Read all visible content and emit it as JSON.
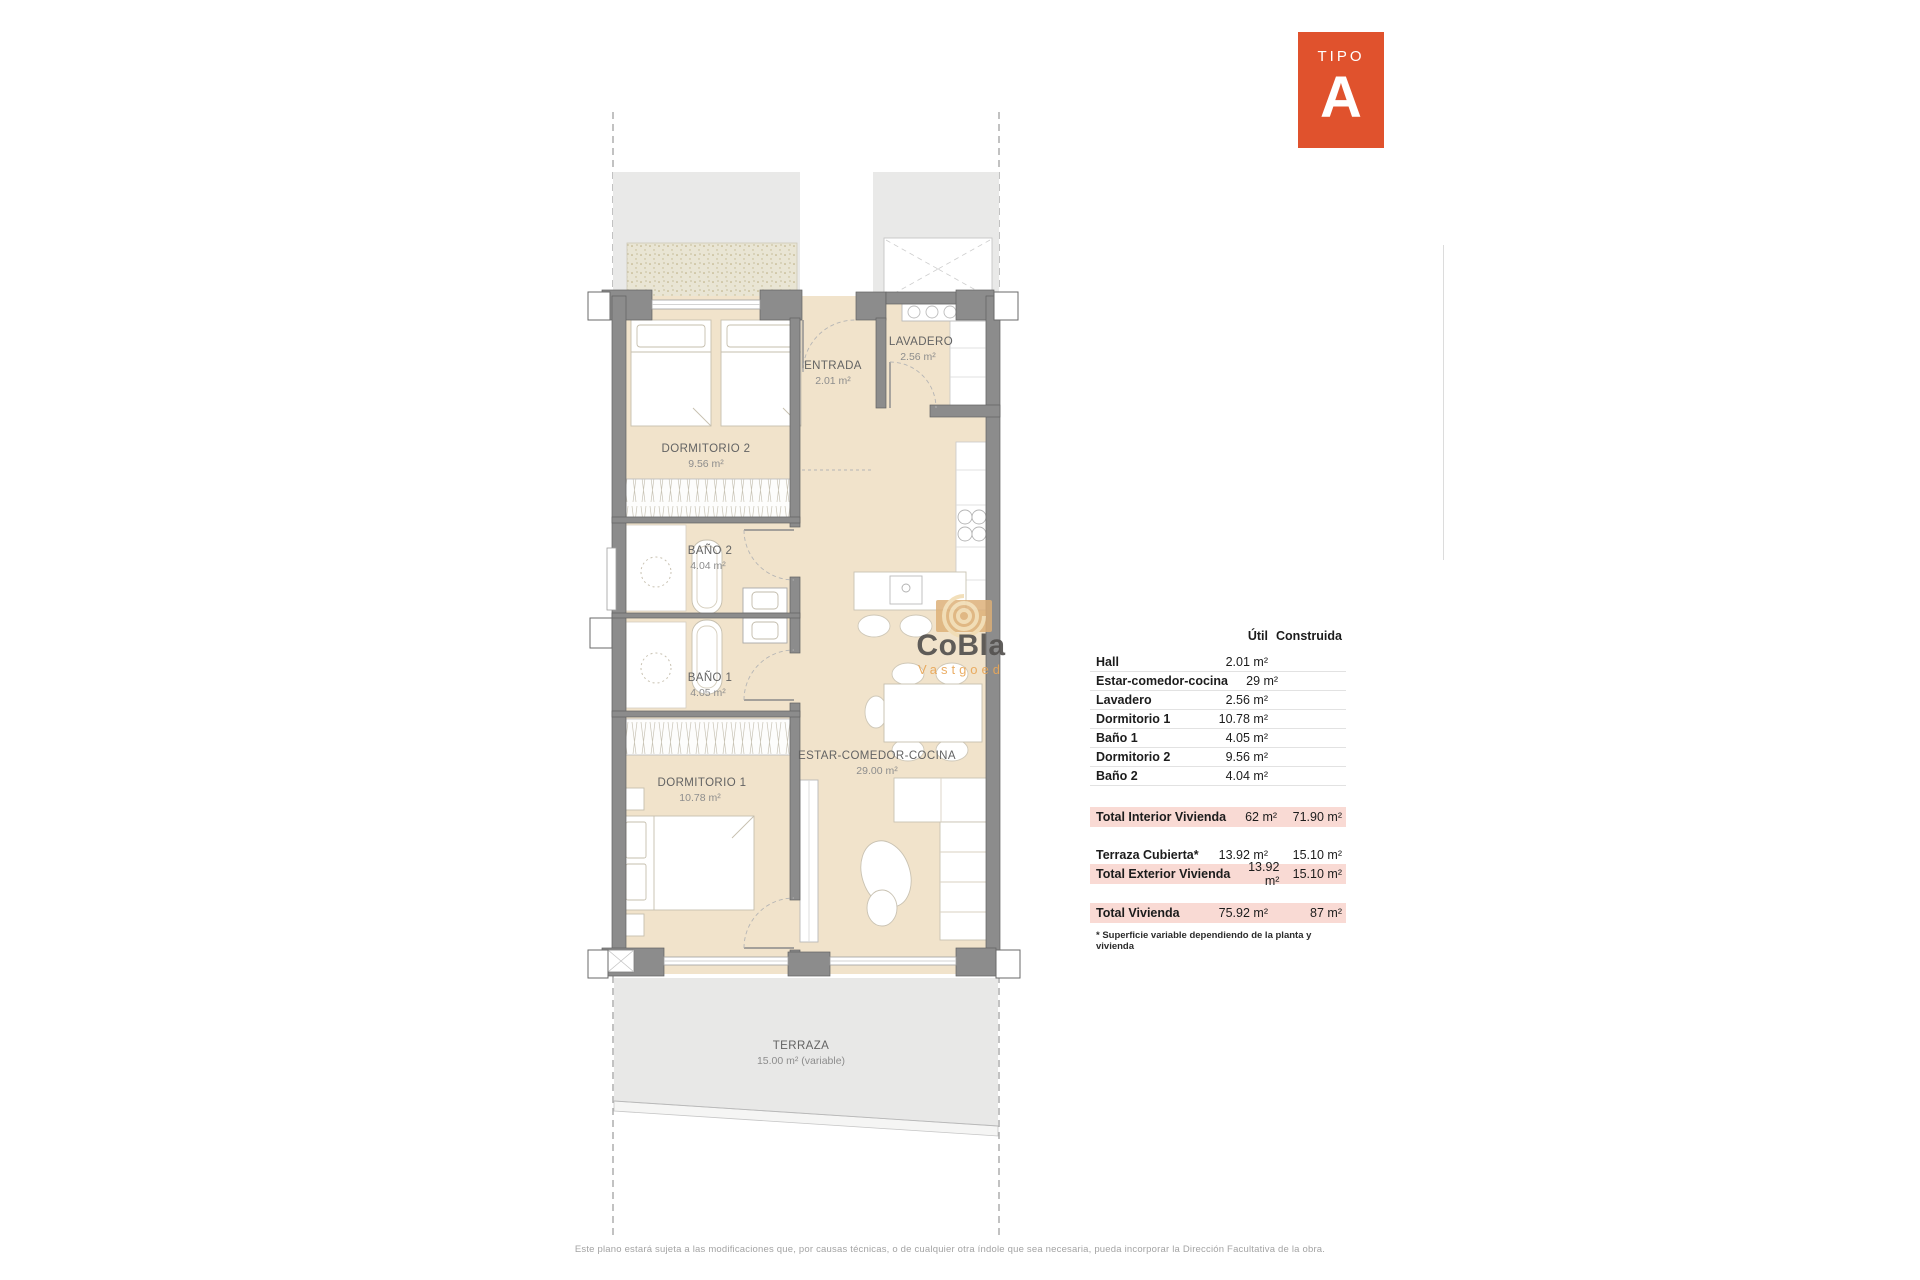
{
  "badge": {
    "type_label": "TIPO",
    "letter": "A",
    "color": "#e0522d"
  },
  "watermark": {
    "brand": "CoBla",
    "sub": "Vastgoed"
  },
  "plan": {
    "rooms": [
      {
        "name": "DORMITORIO 2",
        "area": "9.56 m²"
      },
      {
        "name": "ENTRADA",
        "area": "2.01 m²"
      },
      {
        "name": "LAVADERO",
        "area": "2.56 m²"
      },
      {
        "name": "BAÑO 2",
        "area": "4.04 m²"
      },
      {
        "name": "BAÑO 1",
        "area": "4.05 m²"
      },
      {
        "name": "DORMITORIO 1",
        "area": "10.78 m²"
      },
      {
        "name": "ESTAR-COMEDOR-COCINA",
        "area": "29.00 m²"
      },
      {
        "name": "TERRAZA",
        "area": "15.00 m² (variable)"
      }
    ]
  },
  "table": {
    "headers": {
      "util": "Útil",
      "construida": "Construida"
    },
    "rows": [
      {
        "label": "Hall",
        "util": "2.01 m²",
        "construida": ""
      },
      {
        "label": "Estar-comedor-cocina",
        "util": "29 m²",
        "construida": ""
      },
      {
        "label": "Lavadero",
        "util": "2.56 m²",
        "construida": ""
      },
      {
        "label": "Dormitorio 1",
        "util": "10.78 m²",
        "construida": ""
      },
      {
        "label": "Baño 1",
        "util": "4.05 m²",
        "construida": ""
      },
      {
        "label": "Dormitorio 2",
        "util": "9.56 m²",
        "construida": ""
      },
      {
        "label": "Baño 2",
        "util": "4.04 m²",
        "construida": ""
      }
    ],
    "totals": {
      "interior": {
        "label": "Total Interior Vivienda",
        "util": "62 m²",
        "construida": "71.90 m²"
      },
      "terraza": {
        "label": "Terraza Cubierta*",
        "util": "13.92 m²",
        "construida": "15.10 m²"
      },
      "exterior": {
        "label": "Total Exterior Vivienda",
        "util": "13.92 m²",
        "construida": "15.10 m²"
      },
      "vivienda": {
        "label": "Total Vivienda",
        "util": "75.92 m²",
        "construida": "87 m²"
      }
    },
    "footnote": "* Superficie variable dependiendo de la planta y vivienda"
  },
  "footer": {
    "disclaimer": "Este plano estará sujeta a las modificaciones que, por causas técnicas, o de cualquier otra índole que sea necesaria, pueda incorporar la Dirección Facultativa de la obra."
  }
}
